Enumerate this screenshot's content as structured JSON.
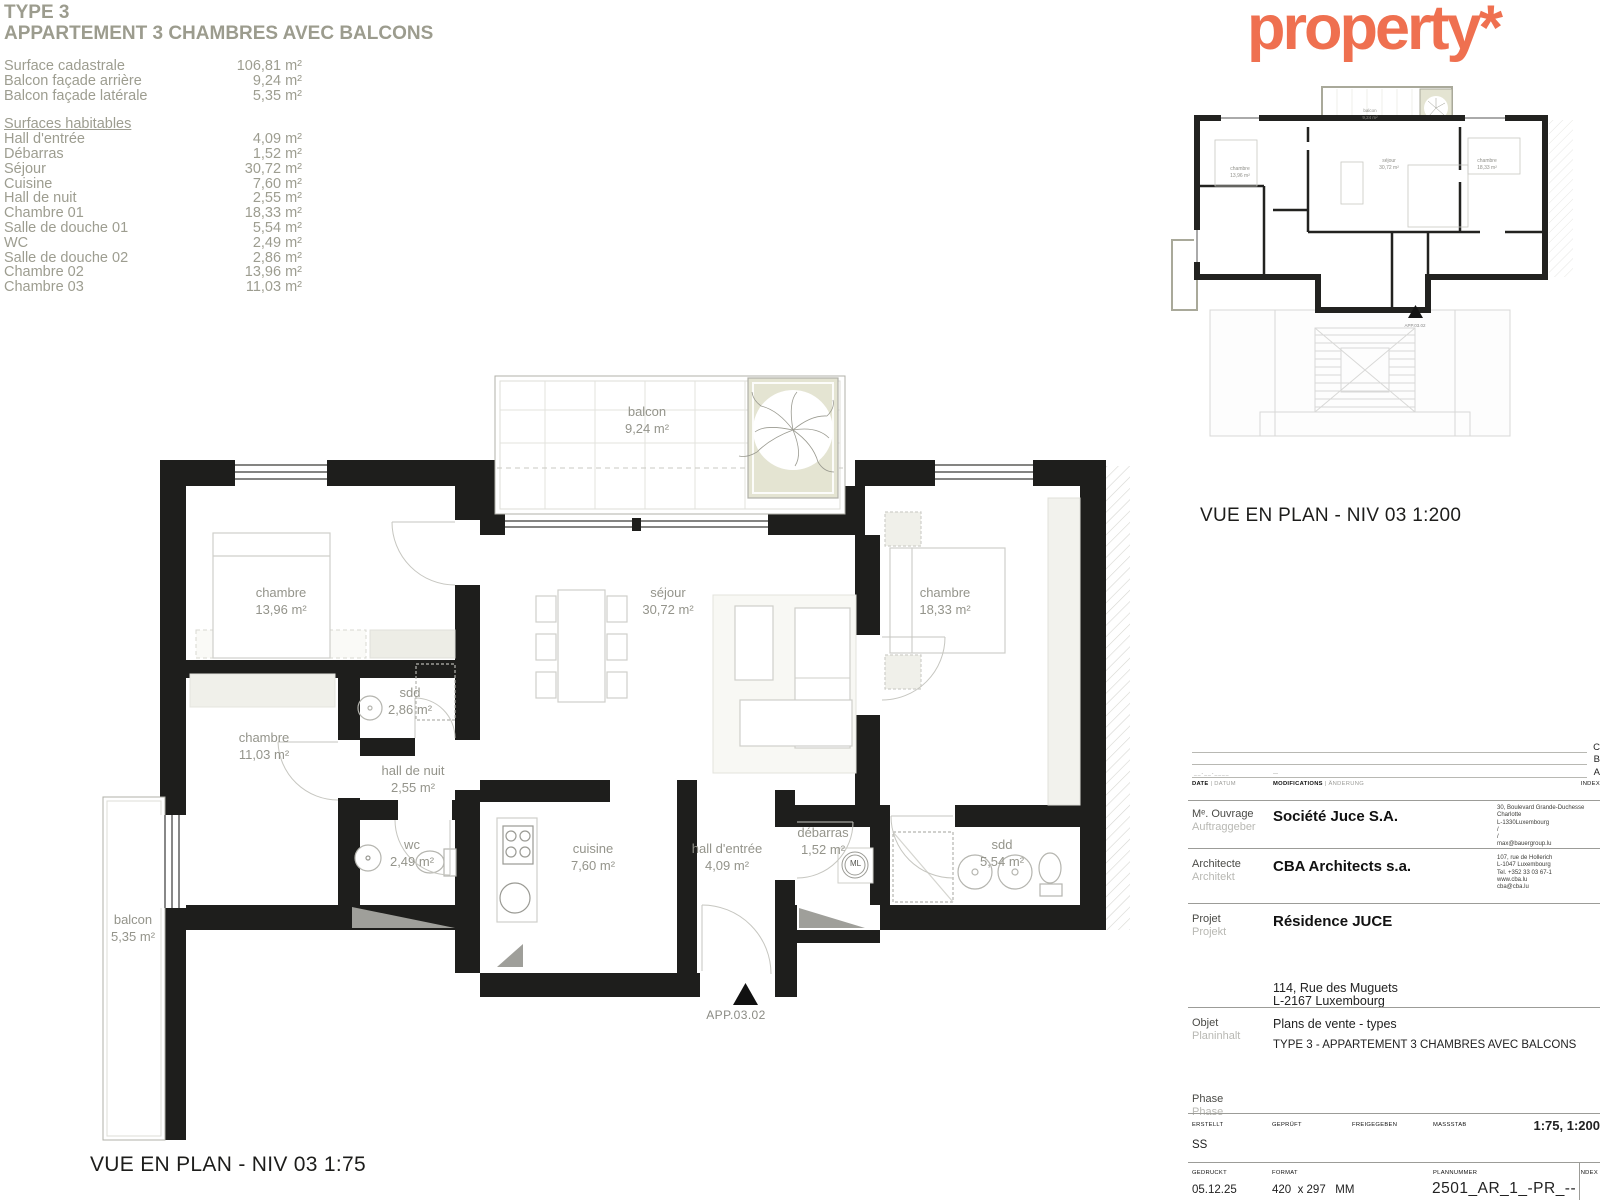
{
  "header": {
    "type_label": "TYPE 3",
    "title": "APPARTEMENT 3 CHAMBRES AVEC BALCONS"
  },
  "logo": {
    "text": "property*",
    "color": "#EF7050"
  },
  "colors": {
    "accent_orange": "#EF7050",
    "wall_black": "#1E1E1C",
    "label_gray": "#94948B",
    "balcony_beige": "#E4E4D2"
  },
  "surface_table": {
    "summary": [
      {
        "label": "Surface cadastrale",
        "value": "106,81 m²"
      },
      {
        "label": "Balcon façade arrière",
        "value": "9,24 m²"
      },
      {
        "label": "Balcon façade latérale",
        "value": "5,35 m²"
      }
    ],
    "habitables_title": "Surfaces habitables",
    "habitables": [
      {
        "label": "Hall d'entrée",
        "value": "4,09 m²"
      },
      {
        "label": "Débarras",
        "value": "1,52 m²"
      },
      {
        "label": "Séjour",
        "value": "30,72 m²"
      },
      {
        "label": "Cuisine",
        "value": "7,60 m²"
      },
      {
        "label": "Hall de nuit",
        "value": "2,55 m²"
      },
      {
        "label": "Chambre 01",
        "value": "18,33 m²"
      },
      {
        "label": "Salle de douche 01",
        "value": "5,54 m²"
      },
      {
        "label": "WC",
        "value": "2,49 m²"
      },
      {
        "label": "Salle de douche 02",
        "value": "2,86 m²"
      },
      {
        "label": "Chambre 02",
        "value": "13,96 m²"
      },
      {
        "label": "Chambre 03",
        "value": "11,03 m²"
      }
    ]
  },
  "plan": {
    "caption": "VUE EN PLAN - NIV 03 1:75",
    "entrance_label": "APP.03.02",
    "rooms": {
      "balcon_arriere": {
        "name": "balcon",
        "area": "9,24 m²"
      },
      "balcon_lateral": {
        "name": "balcon",
        "area": "5,35 m²"
      },
      "chambre_01": {
        "name": "chambre",
        "area": "18,33 m²"
      },
      "chambre_02": {
        "name": "chambre",
        "area": "13,96 m²"
      },
      "chambre_03": {
        "name": "chambre",
        "area": "11,03 m²"
      },
      "sdd_01": {
        "name": "sdd",
        "area": "5,54 m²"
      },
      "sdd_02": {
        "name": "sdd",
        "area": "2,86 m²"
      },
      "hall_de_nuit": {
        "name": "hall de nuit",
        "area": "2,55 m²"
      },
      "wc": {
        "name": "wc",
        "area": "2,49 m²"
      },
      "cuisine": {
        "name": "cuisine",
        "area": "7,60 m²"
      },
      "sejour": {
        "name": "séjour",
        "area": "30,72 m²"
      },
      "hall_entree": {
        "name": "hall d'entrée",
        "area": "4,09 m²"
      },
      "debarras": {
        "name": "débarras",
        "area": "1,52 m²"
      },
      "ml_label": "ML"
    }
  },
  "overview": {
    "caption": "VUE EN PLAN - NIV 03 1:200",
    "entrance_label": "APP.03.02"
  },
  "titleblock": {
    "revisions": [
      {
        "index": "C"
      },
      {
        "index": "B"
      },
      {
        "index": "A"
      }
    ],
    "placeholder_date": "__-__-____",
    "placeholder_mod": "—",
    "headers": {
      "date_fr": "DATE",
      "date_de": "DATUM",
      "mod_fr": "MODIFICATIONS",
      "mod_de": "ÄNDERUNG",
      "index": "INDEX",
      "sep": "|"
    },
    "client": {
      "label_fr": "Mᵉ. Ouvrage",
      "label_de": "Auftraggeber",
      "name": "Société Juce S.A.",
      "address": [
        "30, Boulevard Grande-Duchesse Charlotte",
        "L-1330Luxembourg",
        "/",
        "/",
        "max@bauergroup.lu"
      ]
    },
    "architect": {
      "label_fr": "Architecte",
      "label_de": "Architekt",
      "name": "CBA Architects s.a.",
      "address": [
        "107, rue de Hollerich",
        "L-1047 Luxembourg",
        "Tel. +352 33 03 67-1",
        "www.cba.lu",
        "cba@cba.lu"
      ]
    },
    "project": {
      "label_fr": "Projet",
      "label_de": "Projekt",
      "name": "Résidence JUCE",
      "address_line1": "114, Rue des Muguets",
      "address_line2": "L-2167 Luxembourg"
    },
    "object": {
      "label_fr": "Objet",
      "label_de": "Planinhalt",
      "line1": "Plans de vente - types",
      "line2": "TYPE 3 - APPARTEMENT 3 CHAMBRES AVEC BALCONS"
    },
    "phase": {
      "label_fr": "Phase",
      "label_de": "Phase"
    },
    "approval": {
      "erstellt_header": "ERSTELLT",
      "geprueft_header": "GEPRÜFT",
      "freigegeben_header": "FREIGEGEBEN",
      "massstab_header": "MASSSTAB",
      "massstab_value": "1:75, 1:200",
      "erstellt_value": "SS"
    },
    "print": {
      "gedruckt_header": "GEDRUCKT",
      "format_header": "FORMAT",
      "plannummer_header": "PLANNUMMER",
      "index_header": "INDEX",
      "gedruckt_value": "05.12.25",
      "format_value": "420  x 297   MM",
      "plannummer_value": "2501_AR_1_-PR_--_009"
    }
  }
}
